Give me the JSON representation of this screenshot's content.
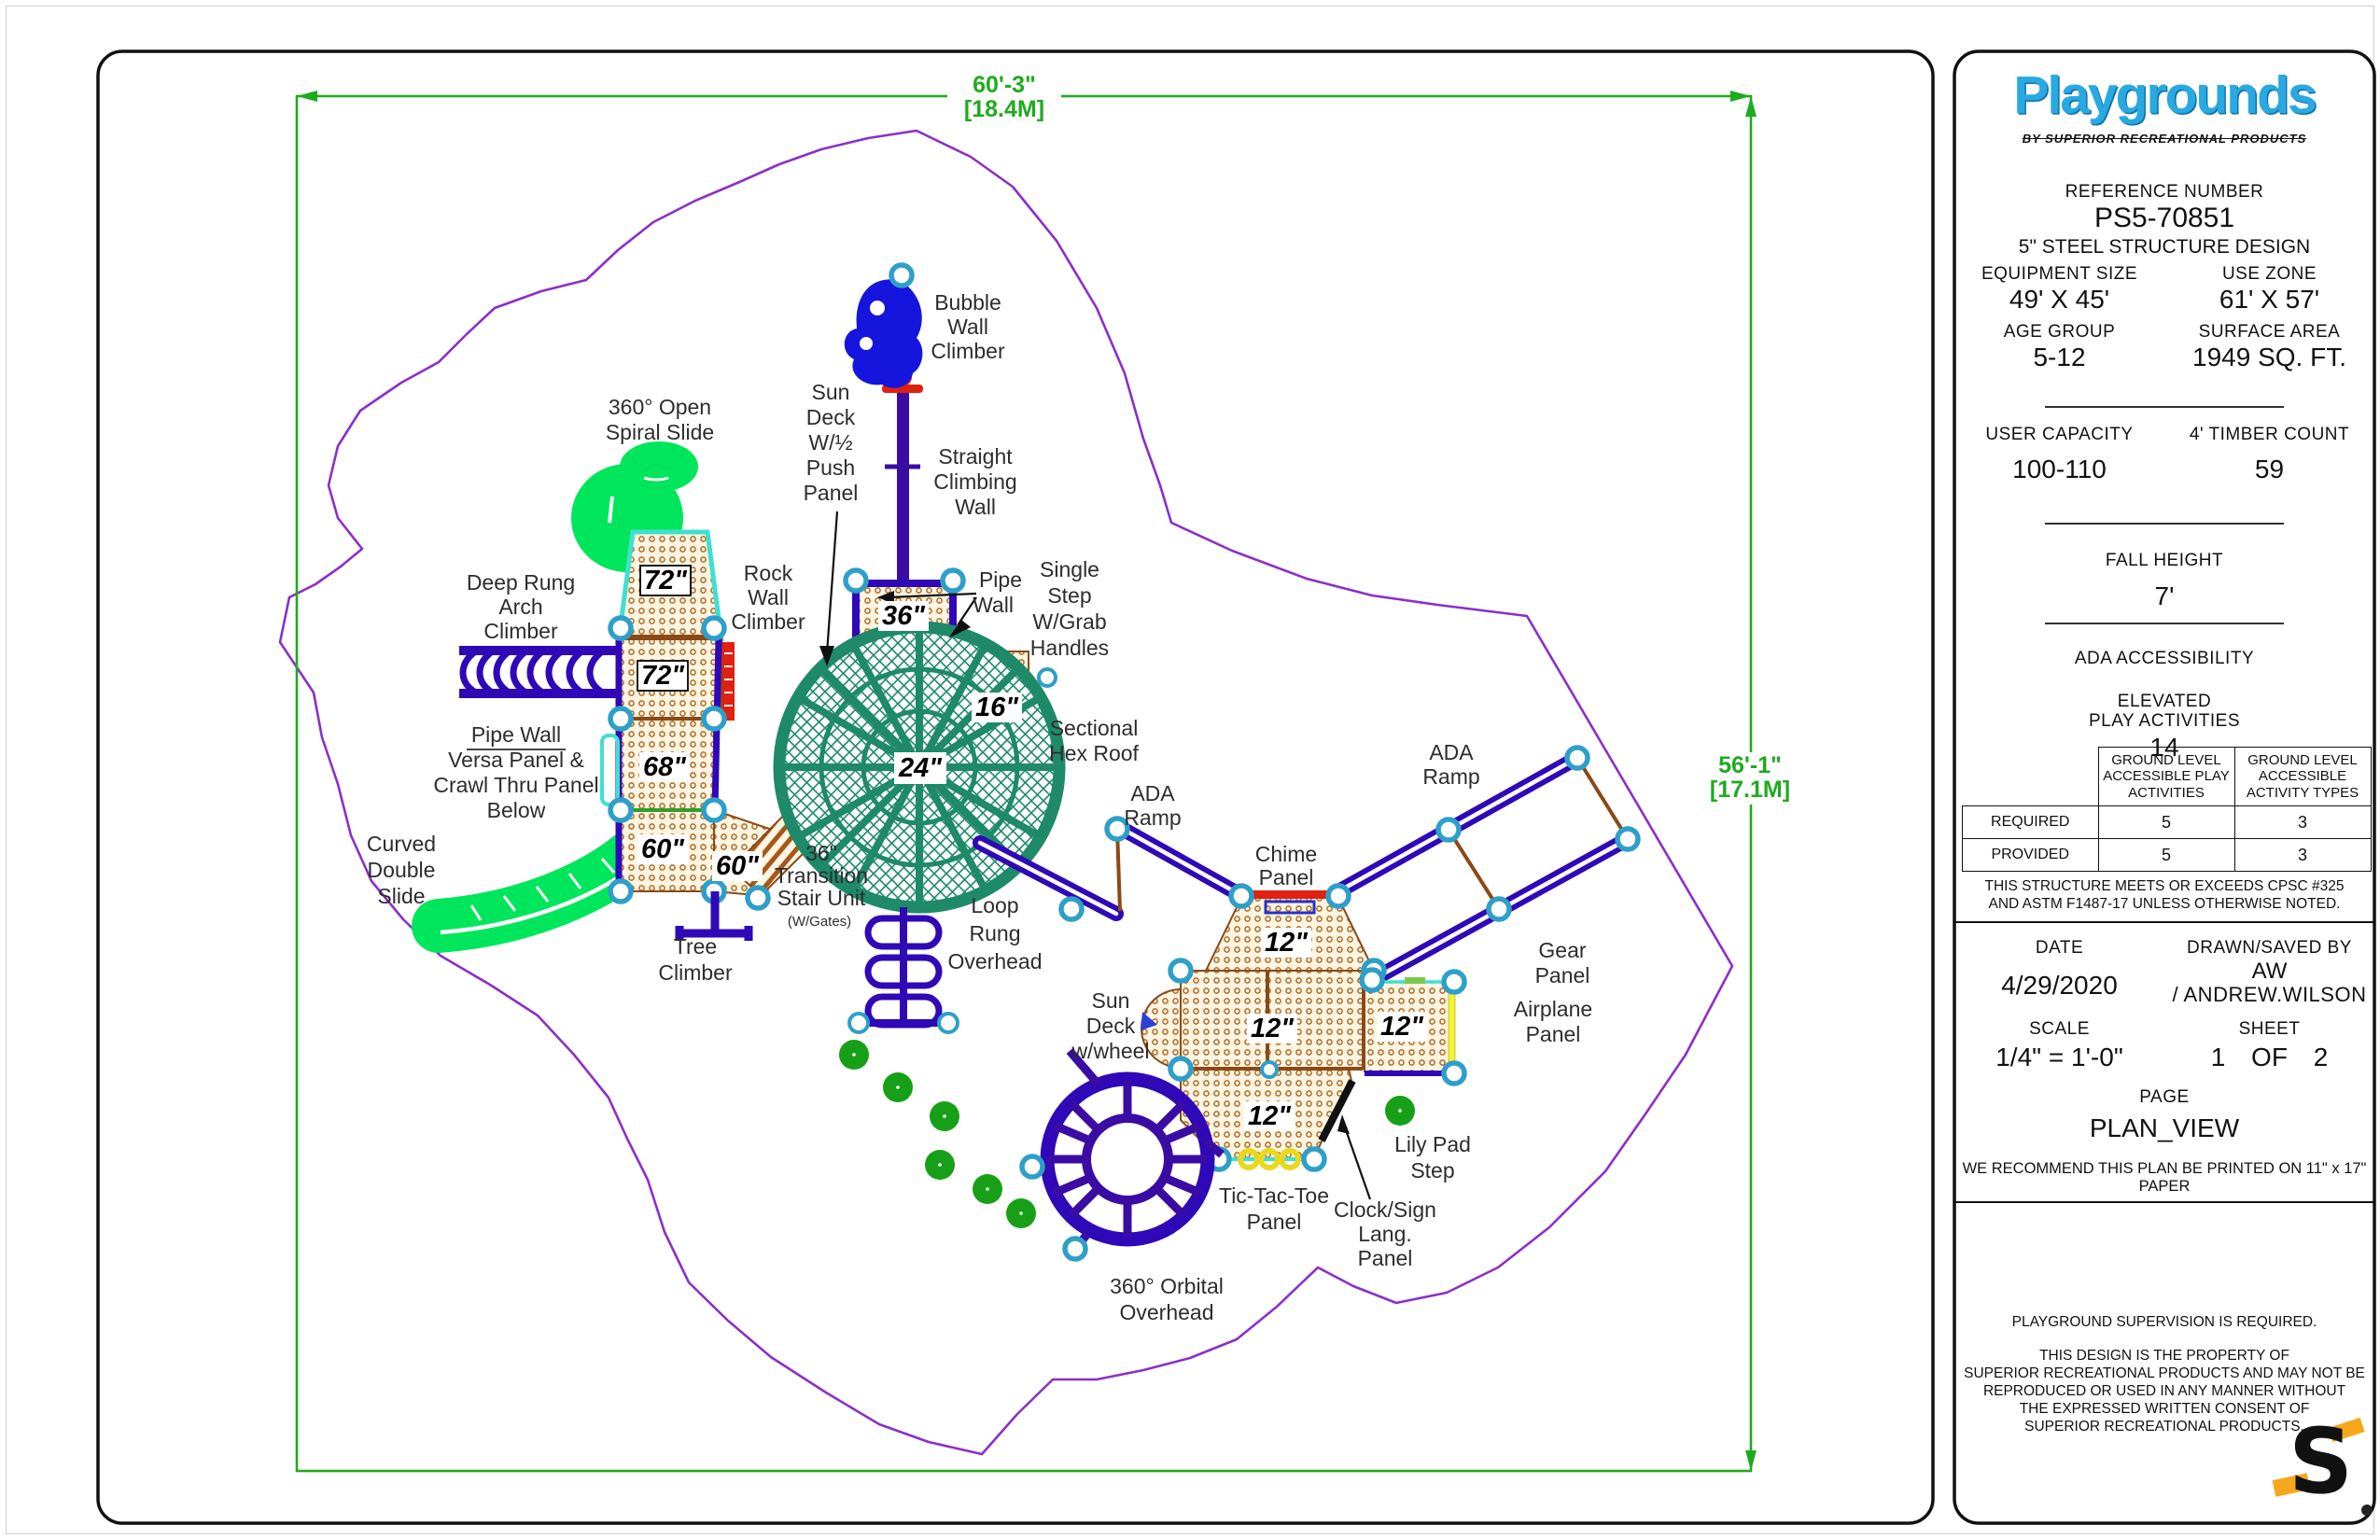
{
  "title_block": {
    "logo": {
      "brand": "Playgrounds",
      "tagline": "BY SUPERIOR RECREATIONAL PRODUCTS",
      "brand_color": "#29a9e1"
    },
    "reference": {
      "label": "REFERENCE NUMBER",
      "number": "PS5-70851",
      "design": "5\" STEEL STRUCTURE DESIGN"
    },
    "specs": {
      "equipment_size_label": "EQUIPMENT SIZE",
      "equipment_size": "49' X 45'",
      "use_zone_label": "USE ZONE",
      "use_zone": "61' X 57'",
      "age_group_label": "AGE GROUP",
      "age_group": "5-12",
      "surface_area_label": "SURFACE AREA",
      "surface_area": "1949 SQ. FT.",
      "user_capacity_label": "USER CAPACITY",
      "user_capacity": "100-110",
      "timber_count_label": "4' TIMBER COUNT",
      "timber_count": "59",
      "fall_height_label": "FALL HEIGHT",
      "fall_height": "7'",
      "ada_label": "ADA ACCESSIBILITY",
      "elevated_label_1": "ELEVATED",
      "elevated_label_2": "PLAY ACTIVITIES",
      "elevated_value": "14"
    },
    "ada_table": {
      "col1": "GROUND LEVEL ACCESSIBLE PLAY ACTIVITIES",
      "col2": "GROUND LEVEL ACCESSIBLE ACTIVITY TYPES",
      "rows": [
        {
          "name": "REQUIRED",
          "play_activities": "5",
          "activity_types": "3"
        },
        {
          "name": "PROVIDED",
          "play_activities": "5",
          "activity_types": "3"
        }
      ]
    },
    "compliance_lines": [
      "THIS STRUCTURE MEETS OR EXCEEDS CPSC #325",
      "AND ASTM F1487-17 UNLESS OTHERWISE NOTED."
    ],
    "meta": {
      "date_label": "DATE",
      "date": "4/29/2020",
      "drawn_label": "DRAWN/SAVED BY",
      "drawn_by": "AW",
      "drawn_by_full": "/ ANDREW.WILSON",
      "scale_label": "SCALE",
      "scale": "1/4\" = 1'-0\"",
      "sheet_label": "SHEET",
      "sheet": "1 OF 2",
      "page_label": "PAGE",
      "page": "PLAN_VIEW",
      "print_note": "WE RECOMMEND THIS PLAN BE PRINTED ON 11\" x 17\" PAPER"
    },
    "footer": {
      "supervision": "PLAYGROUND SUPERVISION IS REQUIRED.",
      "copyright_lines": [
        "THIS DESIGN IS THE PROPERTY OF",
        "SUPERIOR RECREATIONAL PRODUCTS AND MAY NOT BE",
        "REPRODUCED OR USED IN ANY MANNER WITHOUT",
        "THE EXPRESSED WRITTEN CONSENT OF",
        "SUPERIOR RECREATIONAL PRODUCTS."
      ],
      "logo_letter": "S"
    }
  },
  "plan": {
    "dimensions": {
      "width_label": "60'-3\"",
      "width_metric": "[18.4M]",
      "height_label": "56'-1\"",
      "height_metric": "[17.1M]"
    },
    "decks": [
      "72\"",
      "72\"",
      "68\"",
      "60\"",
      "60\"",
      "36\"",
      "24\"",
      "16\"",
      "12\"",
      "12\"",
      "12\"",
      "12\""
    ],
    "labels": {
      "bubble_wall": {
        "lines": [
          "Bubble",
          "Wall",
          "Climber"
        ]
      },
      "sun_deck_push": {
        "lines": [
          "Sun",
          "Deck",
          "W/½",
          "Push",
          "Panel"
        ]
      },
      "straight_climbing_wall": {
        "lines": [
          "Straight",
          "Climbing",
          "Wall"
        ]
      },
      "spiral_slide": {
        "lines": [
          "360° Open",
          "Spiral Slide"
        ]
      },
      "deep_rung": {
        "lines": [
          "Deep Rung",
          "Arch",
          "Climber"
        ]
      },
      "rock_wall": {
        "lines": [
          "Rock",
          "Wall",
          "Climber"
        ]
      },
      "pipe_wall_pointer": {
        "lines": [
          "Pipe",
          "Wall"
        ]
      },
      "single_step": {
        "lines": [
          "Single",
          "Step",
          "W/Grab",
          "Handles"
        ]
      },
      "sectional_hex_roof": {
        "lines": [
          "Sectional",
          "Hex Roof"
        ]
      },
      "pipe_wall_versa": {
        "lines": [
          "Pipe Wall",
          "Versa Panel &",
          "Crawl Thru Panel",
          "Below"
        ]
      },
      "curved_double_slide": {
        "lines": [
          "Curved",
          "Double",
          "Slide"
        ]
      },
      "tree_climber": {
        "lines": [
          "Tree",
          "Climber"
        ]
      },
      "transition_stair": {
        "lines": [
          "36\"",
          "Transition",
          "Stair Unit"
        ],
        "sub": "(W/Gates)"
      },
      "loop_rung": {
        "lines": [
          "Loop",
          "Rung",
          "Overhead"
        ]
      },
      "ada_ramp_left": {
        "lines": [
          "ADA",
          "Ramp"
        ]
      },
      "ada_ramp_right": {
        "lines": [
          "ADA",
          "Ramp"
        ]
      },
      "chime_panel": {
        "lines": [
          "Chime",
          "Panel"
        ]
      },
      "sun_deck_wheel": {
        "lines": [
          "Sun",
          "Deck",
          "w/wheel"
        ]
      },
      "gear_panel": {
        "lines": [
          "Gear",
          "Panel"
        ]
      },
      "airplane_panel": {
        "lines": [
          "Airplane",
          "Panel"
        ]
      },
      "lily_pad_step": {
        "lines": [
          "Lily Pad",
          "Step"
        ]
      },
      "tic_tac_toe": {
        "lines": [
          "Tic-Tac-Toe",
          "Panel"
        ]
      },
      "clock_sign": {
        "lines": [
          "Clock/Sign",
          "Lang.",
          "Panel"
        ]
      },
      "orbital_overhead": {
        "lines": [
          "360° Orbital",
          "Overhead"
        ]
      }
    },
    "colors": {
      "structure": "#2f08b8",
      "roof": "#1e8a68",
      "slide": "#00e65c",
      "deck_dot": "#b06a24",
      "dimension": "#1faa1f",
      "use_zone": "#8b2fc9",
      "post_ring": "#2e9fc9",
      "alert_red": "#e02010",
      "lily": "#17a017",
      "panel_yellow": "#f2ef3d"
    }
  }
}
